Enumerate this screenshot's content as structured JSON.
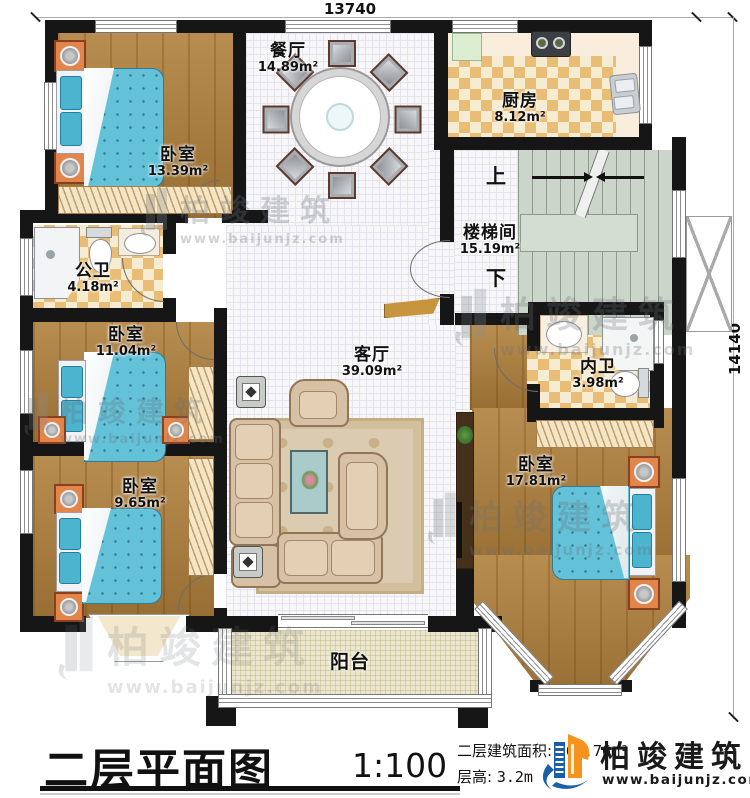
{
  "dimensions": {
    "top": "13740",
    "right": "14140"
  },
  "rooms": [
    {
      "id": "dining",
      "name": "餐厅",
      "area": "14.89m²"
    },
    {
      "id": "kitchen",
      "name": "厨房",
      "area": "8.12m²"
    },
    {
      "id": "bedroom-top-left",
      "name": "卧室",
      "area": "13.39m²"
    },
    {
      "id": "stairwell",
      "name": "楼梯间",
      "area": "15.19m²"
    },
    {
      "id": "public-bath",
      "name": "公卫",
      "area": "4.18m²"
    },
    {
      "id": "bedroom-mid-left",
      "name": "卧室",
      "area": "11.04m²"
    },
    {
      "id": "living",
      "name": "客厅",
      "area": "39.09m²"
    },
    {
      "id": "inner-bath",
      "name": "内卫",
      "area": "3.98m²"
    },
    {
      "id": "bedroom-bottom-left",
      "name": "卧室",
      "area": "9.65m²"
    },
    {
      "id": "bedroom-bottom-right",
      "name": "卧室",
      "area": "17.81m²"
    },
    {
      "id": "balcony",
      "name": "阳台",
      "area": ""
    }
  ],
  "stairs": {
    "up": "上",
    "down": "下"
  },
  "title": {
    "name": "二层平面图",
    "scale": "1:100"
  },
  "info": {
    "area_label": "二层建筑面积:",
    "area_value": "161.76m²",
    "height_label": "层高:",
    "height_value": "3.2m"
  },
  "brand": {
    "name": "柏竣建筑",
    "site": "www.baijunjz.com"
  },
  "watermark": {
    "name": "柏竣建筑",
    "site": "www.baijunjz.com"
  },
  "icons": {
    "logo": "building-logo-icon",
    "watermark": "building-watermark-icon"
  },
  "colors": {
    "wall": "#161616",
    "wood_floor": "#b0803c",
    "bed": "#64c2d8",
    "checker": "#e9bd75",
    "stairs": "#cbd5ca",
    "balcony_floor": "#ebe6cd",
    "brand_blue": "#1b5ea8",
    "brand_orange": "#f6921e"
  }
}
